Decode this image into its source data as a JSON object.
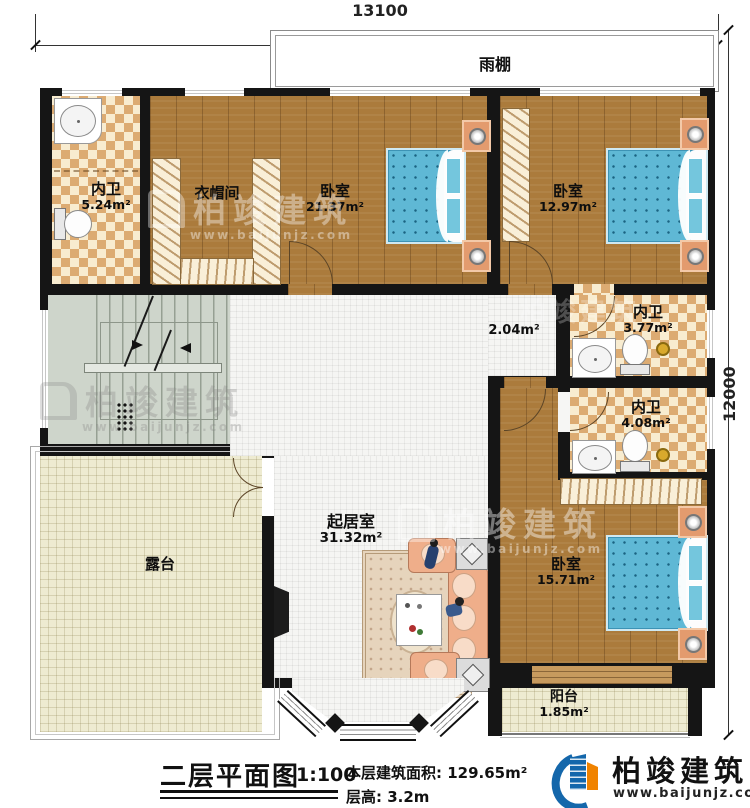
{
  "dimensions": {
    "top": "13100",
    "right": "12000"
  },
  "canopy": {
    "label": "雨棚"
  },
  "rooms": {
    "wc1": {
      "name": "内卫",
      "area": "5.24m²"
    },
    "cloak": {
      "name": "衣帽间"
    },
    "bedroom1": {
      "name": "卧室",
      "area": "21.37m²"
    },
    "bedroom2": {
      "name": "卧室",
      "area": "12.97m²"
    },
    "stair": {
      "name": "楼梯间",
      "area": "11.81m²",
      "down": "下",
      "up": "上"
    },
    "lobby": {
      "area": "2.04m²"
    },
    "wc2": {
      "name": "内卫",
      "area": "3.77m²"
    },
    "wc3": {
      "name": "内卫",
      "area": "4.08m²"
    },
    "living": {
      "name": "起居室",
      "area": "31.32m²"
    },
    "bedroom3": {
      "name": "卧室",
      "area": "15.71m²"
    },
    "terrace": {
      "name": "露台"
    },
    "balcony": {
      "name": "阳台",
      "area": "1.85m²"
    }
  },
  "titleblock": {
    "title": "二层平面图",
    "scale": "1:100",
    "area_label": "本层建筑面积: 129.65m²",
    "height_label": "层高: 3.2m"
  },
  "brand": {
    "name": "柏竣建筑",
    "site": "www.baijunjz.com"
  },
  "watermark": {
    "name": "柏竣建筑",
    "site": "www.baijunjz.com"
  },
  "colors": {
    "wall": "#151515",
    "wood": "#ab7b3c",
    "tile_cream": "#f8ecd0",
    "tile_tan": "#dcab72",
    "bed_blue": "#5fb8d5",
    "stair": "#ced5cb",
    "terrace": "#eeebd1",
    "brand_blue": "#1467ab",
    "brand_orange": "#f08300"
  }
}
